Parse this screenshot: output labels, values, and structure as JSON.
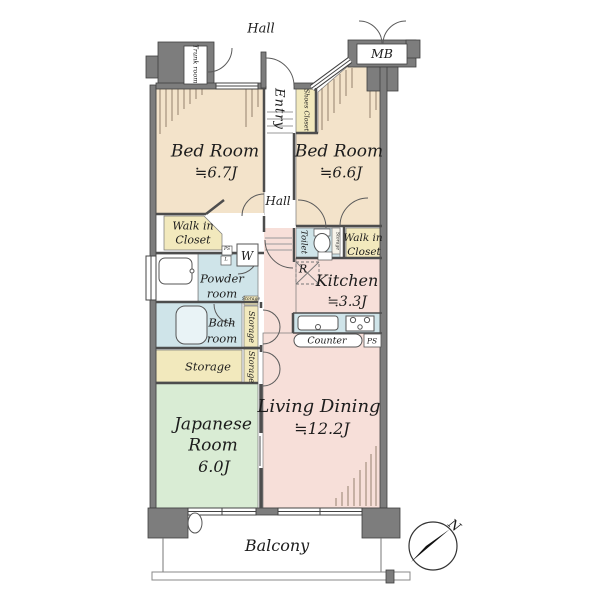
{
  "plan": {
    "outside": {
      "hall_top": "Hall",
      "balcony": "Balcony",
      "north": "N"
    },
    "rooms": {
      "trunk": "Trunk room",
      "mb": "MB",
      "entry": "Entry",
      "shoes_closet": "Shoes Closet",
      "bed_left": {
        "name": "Bed Room",
        "size": "≒6.7J"
      },
      "bed_right": {
        "name": "Bed Room",
        "size": "≒6.6J"
      },
      "hall_mid": "Hall",
      "wic_left": {
        "line1": "Walk in",
        "line2": "Closet"
      },
      "wic_right": {
        "line1": "Walk in",
        "line2": "Closet"
      },
      "toilet": "Toilet",
      "toilet_storage": "Storage",
      "washer": "W",
      "ps_small": "PS",
      "linen_small": "L",
      "powder": {
        "line1": "Powder",
        "line2": "room"
      },
      "fridge": "R",
      "kitchen": {
        "name": "Kitchen",
        "size": "≒3.3J"
      },
      "bath": {
        "line1": "Bath",
        "line2": "room"
      },
      "storage_mini": "Storage",
      "storage_v1": "Storage",
      "storage_v2": "Storage",
      "counter": "Counter",
      "ps_box": "PS",
      "storage_h": "Storage",
      "japanese": {
        "name1": "Japanese",
        "name2": "Room",
        "size": "6.0J"
      },
      "living_dining": {
        "name": "Living Dining",
        "size": "≒12.2J"
      }
    },
    "colors": {
      "bedroom_tan": "#f3e3ca",
      "closet_yellow": "#f2e9bd",
      "wet_blue": "#cfe4e9",
      "ld_pink": "#f7dfd9",
      "tatami_green": "#d9ecd4",
      "wall_gray": "#7d7d7d"
    }
  }
}
